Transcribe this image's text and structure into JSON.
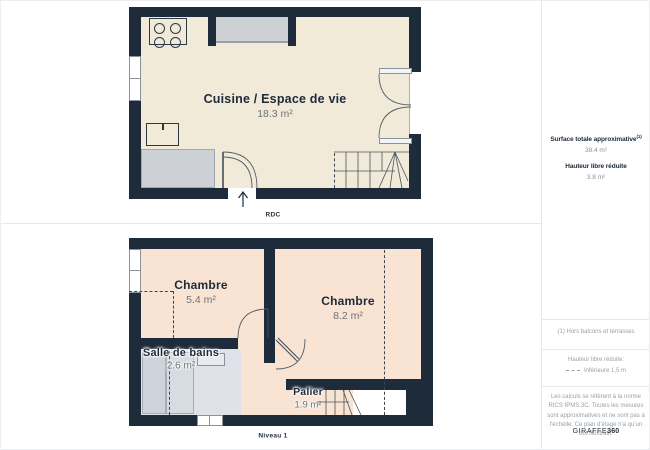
{
  "plans": {
    "rdc": {
      "floor_label": "RDC",
      "kitchen_name": "Cuisine / Espace de vie",
      "kitchen_area": "18.3 m²"
    },
    "niveau1": {
      "floor_label": "Niveau 1",
      "bedroom1_name": "Chambre",
      "bedroom1_area": "5.4 m²",
      "bedroom2_name": "Chambre",
      "bedroom2_area": "8.2 m²",
      "bathroom_name": "Salle de bains",
      "bathroom_area": "2.6 m²",
      "landing_name": "Palier",
      "landing_area": "1.9 m²"
    }
  },
  "sidebar": {
    "surface_title": "Surface totale approximative",
    "surface_footnote_ref": "(1)",
    "surface_value": "38.4 m²",
    "height_title": "Hauteur libre réduite",
    "height_value": "3.8 m²",
    "footnote": "(1) Hors balcons et terrasses",
    "legend_title": "Hauteur libre réduite:",
    "legend_label": "Inférieure 1,5 m",
    "disclaimer": "Les calculs se réfèrent à la norme RICS IPMS 3C. Toutes les mesures sont approximatives et ne sont pas à l'échelle. Ce plan d'étage n'a qu'un but illustratif.",
    "brand_name": "GIRAFFE",
    "brand_suffix": "360"
  },
  "colors": {
    "wall": "#1d2b3a",
    "floor_rdc": "#f1ead9",
    "floor_niveau1": "#f9e3d3",
    "floor_bathroom": "#dfe3e9",
    "counter_gray": "#cdd1d6",
    "text_dark": "#1d2b3a",
    "text_muted": "#6e7377"
  }
}
